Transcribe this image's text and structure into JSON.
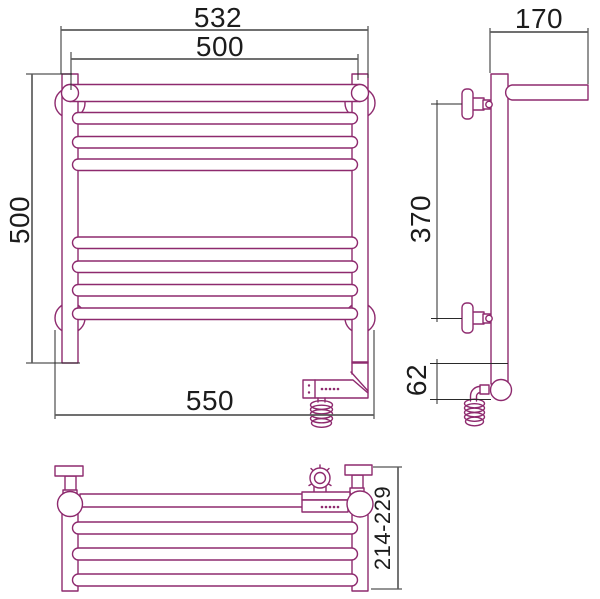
{
  "drawing": {
    "kind": "heated-towel-rail-technical-drawing",
    "colors": {
      "product_outline": "#8e2a6e",
      "dimension_line": "#5c5c5c",
      "extension_line": "#2a2a2a",
      "label_text": "#1c1c1c",
      "background": "#ffffff"
    },
    "dimensions": {
      "front": {
        "overall_width": "532",
        "mounting_width": "500",
        "height": "500",
        "bottom_width": "550"
      },
      "side": {
        "depth": "170",
        "bracket_spacing": "370",
        "heater_drop": "62"
      },
      "top": {
        "depth_range": "214-229"
      }
    },
    "structure": {
      "front_rail_count": 7,
      "top_view_rail_count": 3,
      "views": [
        "front",
        "side",
        "top"
      ]
    }
  }
}
